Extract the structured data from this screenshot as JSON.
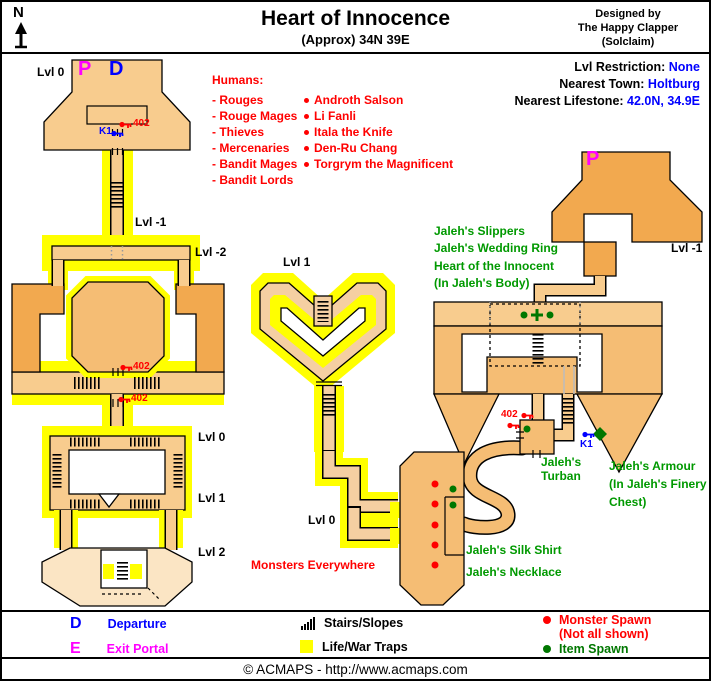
{
  "colors": {
    "trap": "#FFFF00",
    "red": "#FF0000",
    "green": "#009900",
    "item": "#007700",
    "blue": "#0000FF",
    "magenta": "#FF00FF",
    "tan_light": "#F8CC8E",
    "orange_mid": "#F2A94F",
    "tan_mid": "#F5BD74",
    "tan_heart": "#F5CFA2",
    "pale": "#FBE5C4"
  },
  "header": {
    "north": "N",
    "title": "Heart of Innocence",
    "subtitle": "(Approx) 34N 39E",
    "designer": [
      "Designed by",
      "The Happy Clapper",
      "(Solclaim)"
    ]
  },
  "info": {
    "rows": [
      {
        "label": "Lvl Restriction: ",
        "value": "None"
      },
      {
        "label": "Nearest Town: ",
        "value": "Holtburg"
      },
      {
        "label": "Nearest Lifestone: ",
        "value": "42.0N, 34.9E"
      }
    ]
  },
  "humans": {
    "heading": "Humans:",
    "types": [
      "- Rouges",
      "- Rouge Mages",
      "- Thieves",
      "- Mercenaries",
      "- Bandit Mages",
      "- Bandit Lords"
    ],
    "named": [
      "Androth Salson",
      "Li Fanli",
      "Itala the Knife",
      "Den-Ru Chang",
      "Torgrym the Magnificent"
    ]
  },
  "levels": {
    "entrance": "Lvl 0",
    "left_m1": "Lvl -1",
    "left_m2": "Lvl -2",
    "heart": "Lvl 1",
    "ring_top": "Lvl 0",
    "ring_bottom": "Lvl 1",
    "lower": "Lvl 2",
    "center": "Lvl 0",
    "right_m1": "Lvl -1"
  },
  "markers": {
    "portal_in": "P",
    "departure": "D",
    "portal_out": "P",
    "key_k1_a": "K1",
    "key_k1_b": "K1",
    "door_402_a": "402",
    "door_402_b": "402",
    "door_402_c": "402",
    "door_402_d": "402"
  },
  "notes": {
    "monsters": "Monsters Everywhere"
  },
  "loot": {
    "body": [
      "Jaleh's Slippers",
      "Jaleh's Wedding Ring",
      "Heart of the Innocent",
      "(In Jaleh's Body)"
    ],
    "turban": [
      "Jaleh's",
      "Turban"
    ],
    "armour": [
      "Jaleh's Armour",
      "(In Jaleh's Finery",
      "Chest)"
    ],
    "silk_shirt": "Jaleh's Silk Shirt",
    "necklace": "Jaleh's Necklace"
  },
  "legend": {
    "departure_key": "D",
    "departure_label": "Departure",
    "exit_key": "E",
    "exit_label": "Exit Portal",
    "stairs_label": "Stairs/Slopes",
    "traps_label": "Life/War Traps",
    "monster_label": "Monster Spawn",
    "monster_note": "(Not all shown)",
    "item_label": "Item Spawn"
  },
  "footer": "© ACMAPS - http://www.acmaps.com"
}
